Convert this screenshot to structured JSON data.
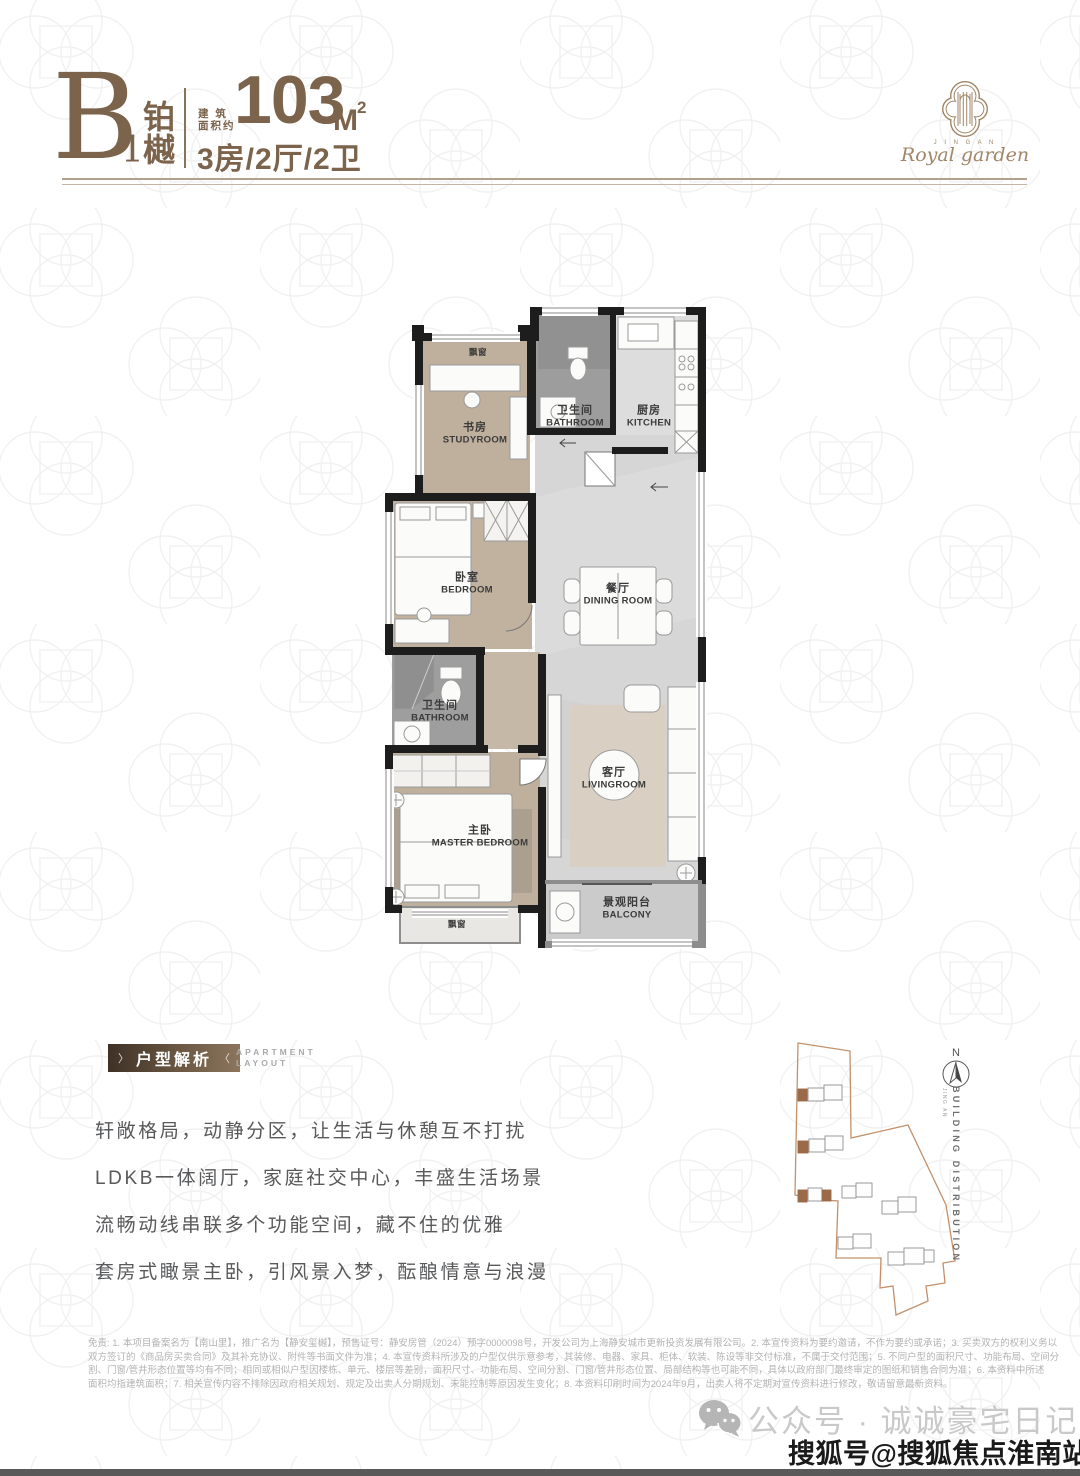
{
  "header": {
    "unit_letter": "B",
    "unit_number": "1",
    "unit_name_char1": "铂",
    "unit_name_char2": "樾",
    "area_label_line1": "建 筑",
    "area_label_line2": "面积约",
    "area_value": "103",
    "area_unit": "M",
    "area_unit_sup": "2",
    "layout_spec": "3房/2厅/2卫"
  },
  "logo": {
    "brand_sub": "J I N G A N",
    "brand_script": "Royal garden"
  },
  "floorplan": {
    "labels": [
      {
        "cn": "飘窗",
        "en": ""
      },
      {
        "cn": "书房",
        "en": "STUDYROOM"
      },
      {
        "cn": "卫生间",
        "en": "BATHROOM"
      },
      {
        "cn": "厨房",
        "en": "KITCHEN"
      },
      {
        "cn": "卧室",
        "en": "BEDROOM"
      },
      {
        "cn": "餐厅",
        "en": "DINING ROOM"
      },
      {
        "cn": "卫生间",
        "en": "BATHROOM"
      },
      {
        "cn": "主卧",
        "en": "MASTER BEDROOM"
      },
      {
        "cn": "客厅",
        "en": "LIVINGROOM"
      },
      {
        "cn": "景观阳台",
        "en": "BALCONY"
      },
      {
        "cn": "飘窗",
        "en": ""
      }
    ]
  },
  "analysis": {
    "bracket_left": "〉",
    "bracket_right": "〈",
    "title": "户型解析",
    "subtitle_line1": "APARTMENT",
    "subtitle_line2": "LAYOUT",
    "paragraphs": [
      "轩敞格局，动静分区，让生活与休憩互不打扰",
      "LDKB一体阔厅，家庭社交中心，丰盛生活场景",
      "流畅动线串联多个功能空间，藏不住的优雅",
      "套房式瞰景主卧，引风景入梦，酝酿情意与浪漫"
    ]
  },
  "site": {
    "compass_label": "N",
    "caption": "BUILDING DISTRIBUTION",
    "caption_small": "JING AN"
  },
  "disclaimer": {
    "lines": [
      "免责: 1. 本项目备案名为【南山里】，推广名为【静安玺樾】，预售证号：静安房管（2024）预字0000098号，开发公司为上海静安城市更新投资发展有限公司。2. 本宣传资料为要约邀请，不作为要约或承诺；3. 买卖双方的权利义务以",
      "双方签订的《商品房买卖合同》及其补充协议、附件等书面文件为准；4. 本宣传资料所涉及的户型仅供示意参考，其装修、电器、家具、柜体、软装、陈设等非交付标准，不属于交付范围；5. 不同户型的面积尺寸、功能布局、空间分",
      "割、门窗/管井形态位置等均有不同；相同或相似户型因楼栋、单元、楼层等差别，面积尺寸、功能布局、空间分割、门窗/管井形态位置、局部结构等也可能不同，具体以政府部门最终审定的图纸和销售合同为准；6. 本资料中所述",
      "面积均指建筑面积；7. 相关宣传内容不排除因政府相关规划、规定及出卖人分期规划、未能控制等原因发生变化；8. 本资料印刷时间为2024年9月，出卖人将不定期对宣传资料进行修改，敬请留意最新资料。"
    ]
  },
  "footer": {
    "wechat_label": "公众号 · 诚诚豪宅日记",
    "watermark": "搜狐号@搜狐焦点淮南站"
  }
}
